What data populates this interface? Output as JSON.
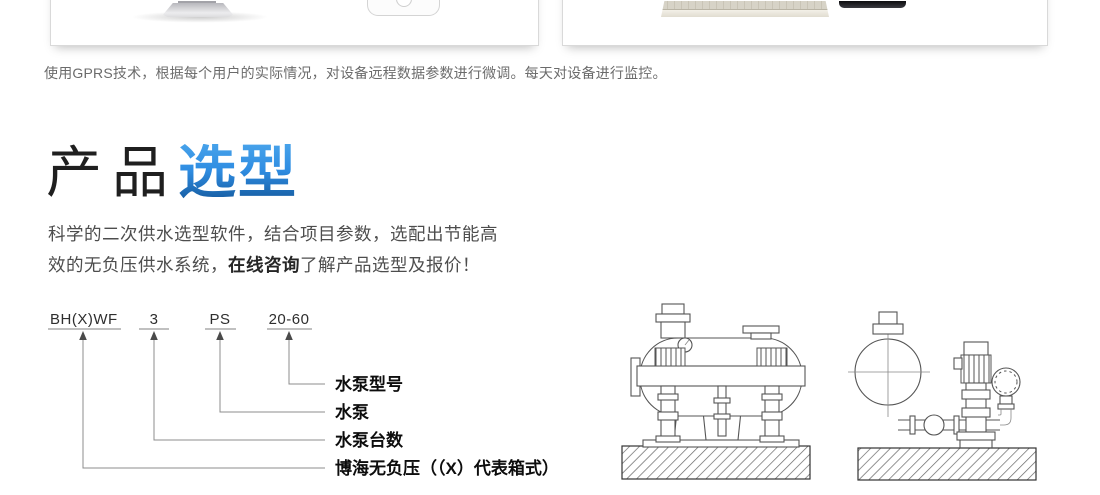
{
  "top_section": {
    "caption": "使用GPRS技术，根据每个用户的实际情况，对设备远程数据参数进行微调。每天对设备进行监控。",
    "left_image": "monitor-stand-and-phone-photo",
    "right_image": "keyboard-and-monitor-photo"
  },
  "heading": {
    "prefix": "产品",
    "highlight": "选型"
  },
  "intro": {
    "line1": "科学的二次供水选型软件，结合项目参数，选配出节能高",
    "line2_before": "效的无负压供水系统，",
    "consult": "在线咨询",
    "line2_after": "了解产品选型及报价！"
  },
  "model_diagram": {
    "segments": [
      {
        "code": "BH(X)WF",
        "label": "博海无负压（（X）代表箱式）"
      },
      {
        "code": "3",
        "label": "水泵台数"
      },
      {
        "code": "PS",
        "label": "水泵"
      },
      {
        "code": "20-60",
        "label": "水泵型号"
      }
    ]
  },
  "illustrations": [
    "horizontal-tank-booster-unit-line-drawing",
    "vertical-pump-and-valve-line-drawing"
  ],
  "colors": {
    "accent_blue_top": "#47a2ea",
    "accent_blue_bottom": "#155a9e",
    "body_text": "#4d4d4d",
    "caption_text": "#6b6b6b"
  }
}
